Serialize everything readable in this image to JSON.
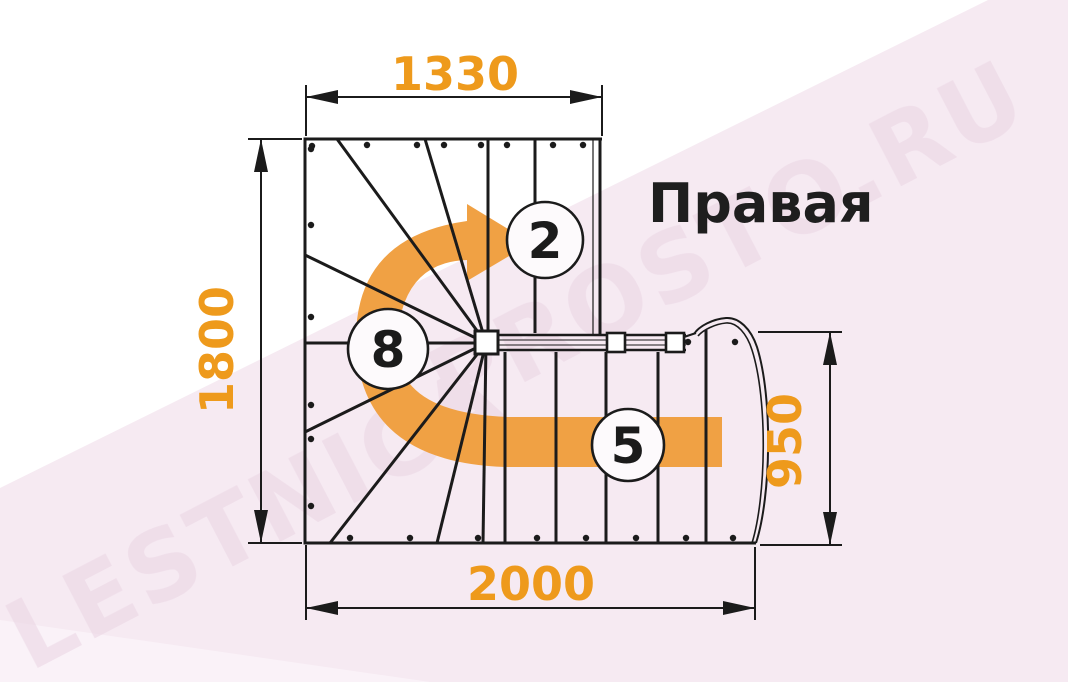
{
  "title": "Правая",
  "watermark": {
    "line1": "LESTNICA",
    "line2": "PROSTO.RU"
  },
  "dimensions": {
    "top_width": "1330",
    "left_depth": "1800",
    "right_height": "950",
    "bottom_width": "2000"
  },
  "step_counts": {
    "top_flight": "2",
    "winder": "8",
    "bottom_flight": "5"
  },
  "colors": {
    "dimension_orange": "#EE9A1C",
    "arrow_orange": "#F0A144",
    "line_black": "#1B1B1B",
    "background_pink": "#F6EAF2",
    "background_pink_light": "#FAF2F8",
    "watermark_pink": "#E9D3E2"
  }
}
